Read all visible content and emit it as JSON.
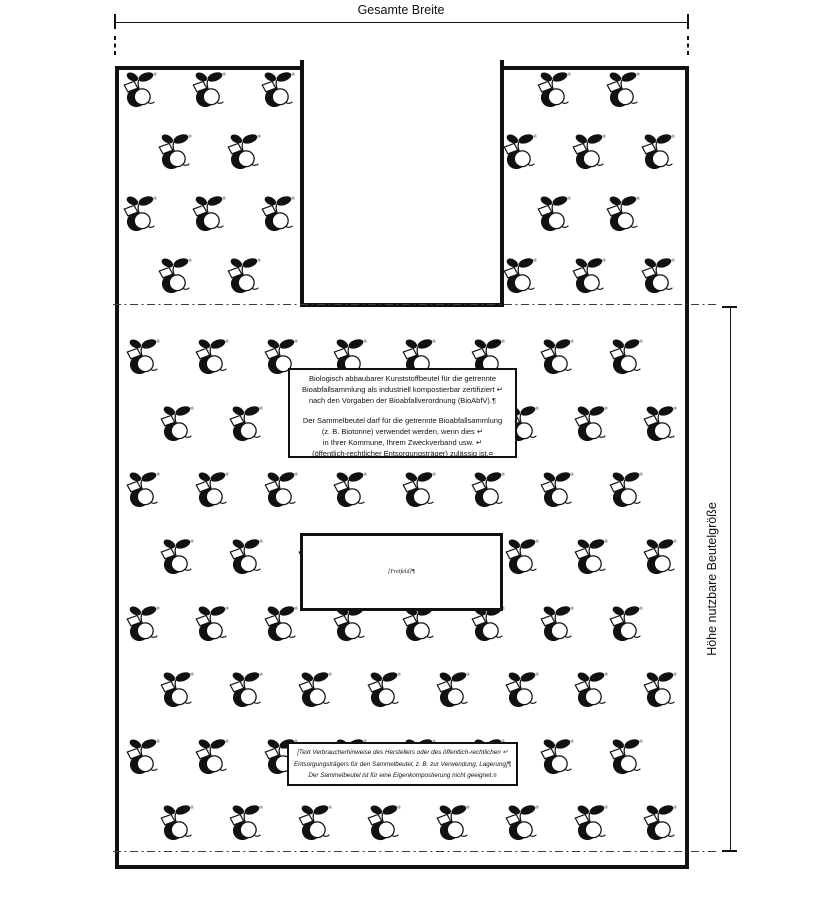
{
  "page": {
    "background": "#ffffff",
    "ink": "#111111",
    "fold_line_color": "#3c3c3c"
  },
  "dimensions": {
    "width_label": "Gesamte Breite",
    "height_label": "Höhe nutzbare Beutelgröße"
  },
  "certification_box": {
    "paragraph1": [
      "Biologisch abbaubarer Kunststoffbeutel für die getrennte",
      "Bioabfallsammlung als industriell kompostierbar zertifiziert ↵",
      "nach den Vorgaben der Bioabfallverordnung (BioAbfV).¶"
    ],
    "paragraph2": [
      "Der Sammelbeutel darf für die getrennte Bioabfallsammlung",
      "(z. B. Biotonne) verwendet werden, wenn dies ↵",
      "in Ihrer Kommune, Ihrem Zweckverband usw. ↵",
      "(öffentlich-rechtlicher Entsorgungsträger) zulässig ist.¤"
    ]
  },
  "freifeld_box": {
    "text": "[Freifeld]¶"
  },
  "consumer_box": {
    "lines": [
      "[Text Verbraucherhinweise des Herstellers oder des öffentlich-rechtlichen ↵",
      "Entsorgungsträgers für den Sammelbeutel, z. B. zur Verwendung, Lagerung]¶",
      "Der Sammelbeutel ist für eine Eigenkompostierung nicht geeignet.¤"
    ]
  },
  "pattern": {
    "logo_name": "apple-sprout-logo",
    "registered_mark": "®",
    "col_spacing": 69,
    "col_max_x": 668,
    "notch_skip_range": [
      293,
      512
    ],
    "handle_rows": [
      [
        90,
        140
      ],
      [
        152,
        175
      ],
      [
        214,
        140
      ],
      [
        276,
        175
      ]
    ],
    "body_rows": [
      [
        357,
        143
      ],
      [
        424,
        177
      ],
      [
        490,
        143
      ],
      [
        557,
        177
      ],
      [
        624,
        143
      ],
      [
        690,
        177
      ],
      [
        757,
        143
      ],
      [
        823,
        177
      ]
    ]
  }
}
